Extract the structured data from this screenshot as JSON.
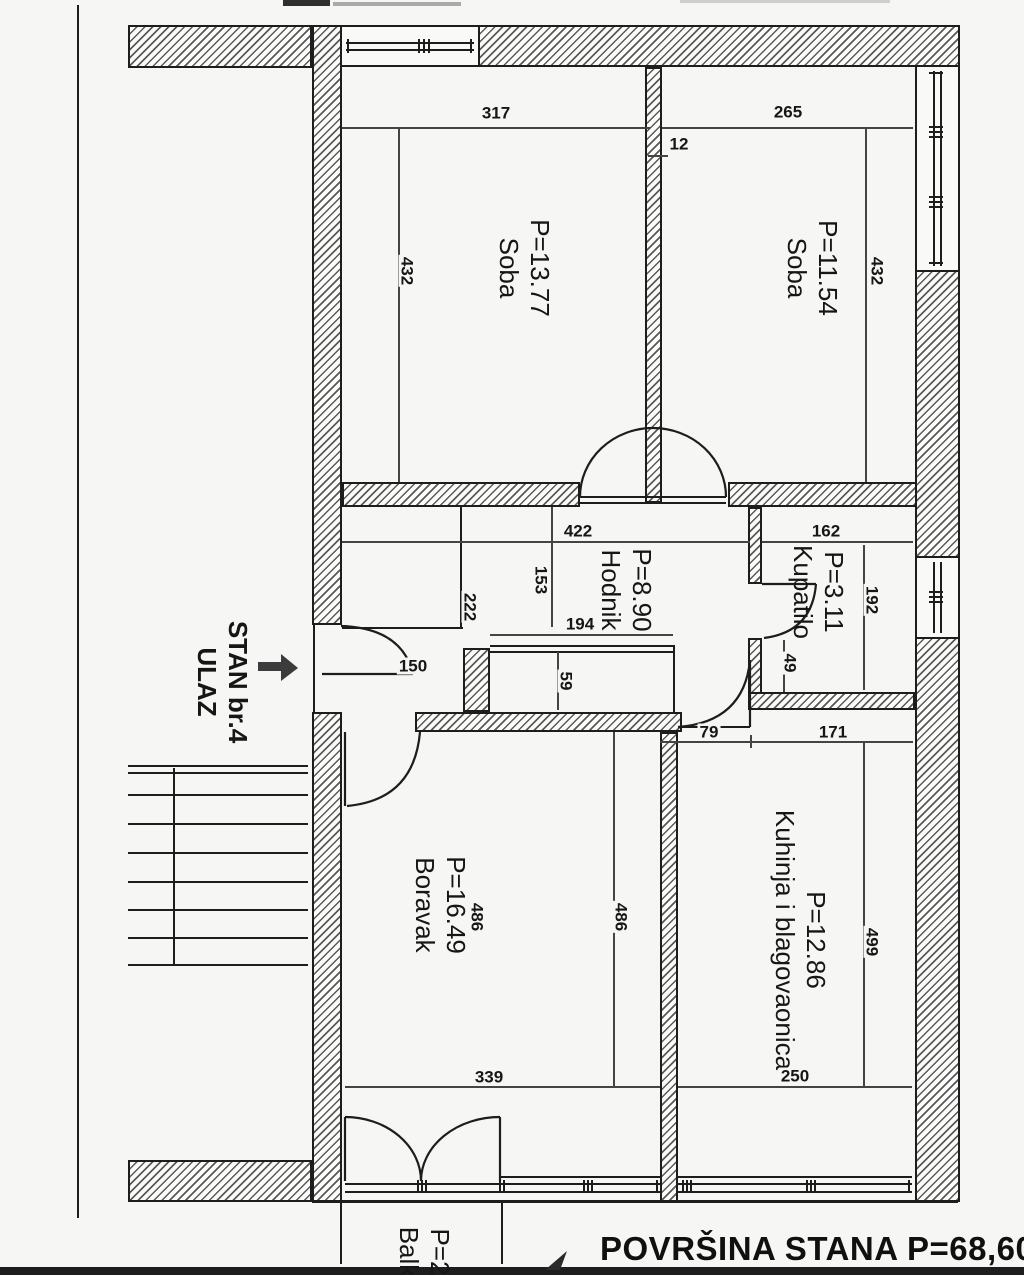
{
  "drawing": {
    "footer_area_statement": "POVRŠINA STANA P=68,60 m2",
    "entrance_label": {
      "line1": "STAN br.4",
      "line2": "ULAZ"
    },
    "balcony_label": {
      "area": "P=2",
      "name": "Balk"
    },
    "rooms": [
      {
        "area": "P=13.77",
        "name": "Soba"
      },
      {
        "area": "P=11.54",
        "name": "Soba"
      },
      {
        "area": "P=8.90",
        "name": "Hodnik"
      },
      {
        "area": "P=3.11",
        "name": "Kupatilo"
      },
      {
        "area": "P=16.49",
        "name": "Boravak"
      },
      {
        "area": "P=12.86",
        "name": "Kuhinja i blagovaonica"
      }
    ],
    "dimensions_cm": {
      "soba1_width": "317",
      "soba2_width": "265",
      "partition_thickness": "12",
      "soba1_depth": "432",
      "soba2_depth": "432",
      "hodnik_width": "422",
      "hodnik_dim_153": "153",
      "hodnik_dim_222": "222",
      "hodnik_dim_194": "194",
      "hodnik_niche_depth": "59",
      "entrance_door_width": "150",
      "kupatilo_width": "162",
      "kupatilo_depth": "192",
      "kupatilo_dim_49": "49",
      "kuhinja_door_width": "79",
      "kuhinja_top_width": "171",
      "boravak_depth_left": "486",
      "boravak_depth_right": "486",
      "kuhinja_depth": "499",
      "boravak_width": "339",
      "kuhinja_width": "250"
    },
    "colors": {
      "paper": "#f6f6f4",
      "ink": "#1d1d1d"
    }
  }
}
